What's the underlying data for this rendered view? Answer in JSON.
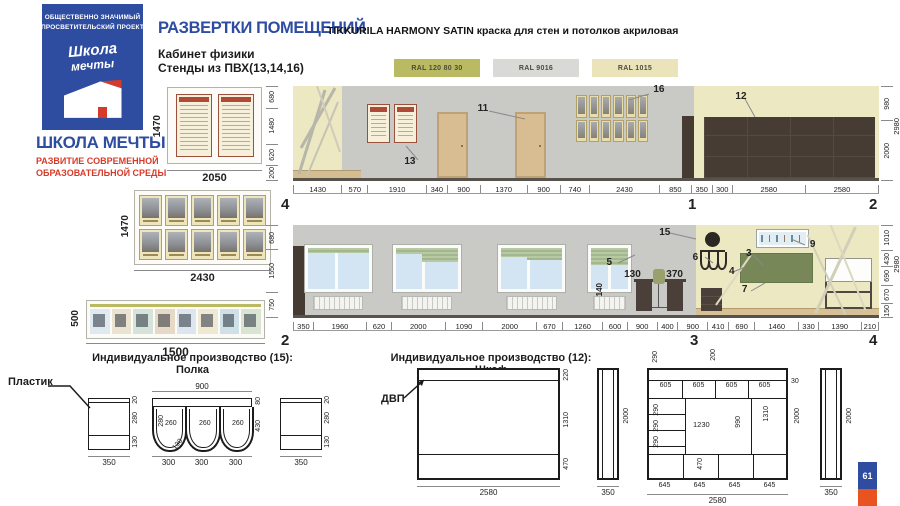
{
  "logo": {
    "banner_line1": "ОБЩЕСТВЕННО ЗНАЧИМЫЙ",
    "banner_line2": "ПРОСВЕТИТЕЛЬСКИЙ ПРОЕКТ",
    "script_word1": "Школа",
    "script_word2": "мечты",
    "org_name": "ШКОЛА МЕЧТЫ",
    "tagline_line1": "РАЗВИТИЕ СОВРЕМЕННОЙ",
    "tagline_line2": "ОБРАЗОВАТЕЛЬНОЙ СРЕДЫ",
    "banner_color": "#2e4da1",
    "accent_red": "#d63b2a",
    "accent_blue": "#2e4da1"
  },
  "header": {
    "title": "РАЗВЕРТКИ ПОМЕЩЕНИЙ",
    "paint_spec": "TIKKURILA HARMONY SATIN краска для стен и потолков акриловая",
    "room_name": "Кабинет физики",
    "stands_note": "Стенды из ПВХ(13,14,16)"
  },
  "swatches": [
    {
      "label": "RAL 120 80 30",
      "color": "#b9ba62"
    },
    {
      "label": "RAL 9016",
      "color": "#d9d9d5"
    },
    {
      "label": "RAL 1015",
      "color": "#ebe4bb"
    }
  ],
  "stands": {
    "alphabet": {
      "height": "1470",
      "width": "2050",
      "grid": {
        "rows": 1,
        "cols": 2
      }
    },
    "portraits": {
      "height": "1470",
      "width": "2430",
      "grid": {
        "rows": 2,
        "cols": 5
      }
    },
    "banner": {
      "height": "500",
      "width": "1500",
      "grid": {
        "rows": 1,
        "cols": 8
      }
    }
  },
  "elevation_top": {
    "marker_left": "4",
    "marker_mid": "1",
    "marker_right": "2",
    "bottom_dims": [
      1430,
      570,
      1910,
      340,
      900,
      1370,
      900,
      740,
      2430,
      850,
      350,
      300,
      2580,
      2580
    ],
    "left_dims": [
      680,
      1480,
      620,
      200
    ],
    "right_dims": [
      980,
      2000
    ],
    "total_height": "2980",
    "label_stand": "13",
    "label_door": "11",
    "label_portraits": "16",
    "label_cabinet": "12",
    "portrait_grid": {
      "rows": 2,
      "cols": 6
    }
  },
  "elevation_bottom": {
    "marker_left": "2",
    "marker_mid": "3",
    "marker_right": "4",
    "bottom_dims": [
      350,
      1960,
      620,
      2000,
      1090,
      2000,
      670,
      1260,
      600,
      900,
      400,
      900,
      410,
      690,
      1460,
      330,
      1390,
      210
    ],
    "left_dims": [
      680,
      1550,
      750
    ],
    "right_dims": [
      1010,
      430,
      690,
      670,
      150
    ],
    "total_height": "2980",
    "label_wall_panel": "15",
    "label_blinds": "5",
    "label_sill": "140",
    "label_desk": "130",
    "label_gap": "370",
    "label_shelf": "6",
    "label_wall": "4",
    "label_board": "3",
    "label_cabinet": "7",
    "label_display": "9"
  },
  "shelf_drawing": {
    "title": "Индивидуальное производство (15): Полка",
    "material": "Пластик",
    "side": {
      "top": "20",
      "mid": "280",
      "bottom": "130",
      "width": "350"
    },
    "front": {
      "width": "900",
      "band": "80",
      "height": "430",
      "inner": "260",
      "depth": "280",
      "radius": "130",
      "cell": "300"
    }
  },
  "cabinet_drawing": {
    "title": "Индивидуальное производство (12): Шкаф",
    "material": "ДВП",
    "front": {
      "width": "2580",
      "top": "220",
      "middle": "1310",
      "bottom": "470"
    },
    "side": {
      "width": "350",
      "height": "2000"
    },
    "detail": {
      "ext_left": "290",
      "ext_mid": "200",
      "shelf_cell": "605",
      "gap": "30",
      "col_cell": "290",
      "opening_w": "1230",
      "opening_h": "990",
      "right_h": "1310",
      "bottom_h": "470",
      "bottom_cell": "645",
      "width": "2580",
      "height": "2000"
    }
  },
  "page_number": "61"
}
